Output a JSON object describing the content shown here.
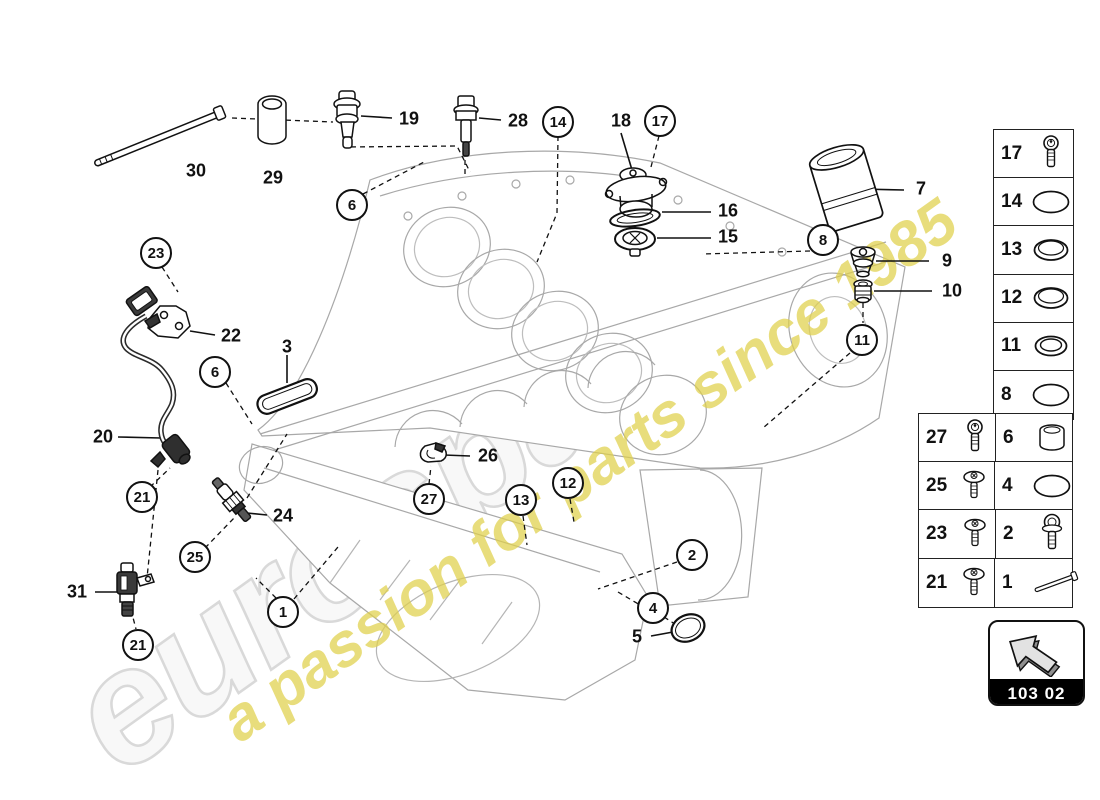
{
  "watermark": {
    "brand": "eurospares",
    "tagline": "a passion for parts since 1985",
    "brand_color": "#f8f8f8",
    "brand_outline": "#d9d9d9",
    "tagline_color": "#e0d04a"
  },
  "nav_box": {
    "code": "103 02"
  },
  "callouts": [
    {
      "n": "14",
      "x": 558,
      "y": 122
    },
    {
      "n": "17",
      "x": 660,
      "y": 121
    },
    {
      "n": "6",
      "x": 352,
      "y": 205
    },
    {
      "n": "8",
      "x": 823,
      "y": 240
    },
    {
      "n": "23",
      "x": 156,
      "y": 253
    },
    {
      "n": "11",
      "x": 862,
      "y": 340
    },
    {
      "n": "6",
      "x": 215,
      "y": 372
    },
    {
      "n": "12",
      "x": 568,
      "y": 483
    },
    {
      "n": "21",
      "x": 142,
      "y": 497
    },
    {
      "n": "27",
      "x": 429,
      "y": 499
    },
    {
      "n": "13",
      "x": 521,
      "y": 500
    },
    {
      "n": "2",
      "x": 692,
      "y": 555
    },
    {
      "n": "25",
      "x": 195,
      "y": 557
    },
    {
      "n": "4",
      "x": 653,
      "y": 608
    },
    {
      "n": "1",
      "x": 283,
      "y": 612
    },
    {
      "n": "21",
      "x": 138,
      "y": 645
    }
  ],
  "part_labels": [
    {
      "n": "30",
      "x": 196,
      "y": 171
    },
    {
      "n": "29",
      "x": 273,
      "y": 178
    },
    {
      "n": "19",
      "x": 409,
      "y": 119
    },
    {
      "n": "28",
      "x": 518,
      "y": 121
    },
    {
      "n": "18",
      "x": 621,
      "y": 121
    },
    {
      "n": "16",
      "x": 728,
      "y": 211
    },
    {
      "n": "15",
      "x": 728,
      "y": 237
    },
    {
      "n": "7",
      "x": 921,
      "y": 189
    },
    {
      "n": "9",
      "x": 947,
      "y": 261
    },
    {
      "n": "10",
      "x": 952,
      "y": 291
    },
    {
      "n": "22",
      "x": 231,
      "y": 336
    },
    {
      "n": "3",
      "x": 287,
      "y": 347
    },
    {
      "n": "20",
      "x": 103,
      "y": 437
    },
    {
      "n": "24",
      "x": 283,
      "y": 516
    },
    {
      "n": "31",
      "x": 77,
      "y": 592
    },
    {
      "n": "26",
      "x": 488,
      "y": 456
    },
    {
      "n": "5",
      "x": 637,
      "y": 637
    }
  ],
  "legend_column": {
    "rows": [
      {
        "num": "17",
        "icon": "socket-bolt"
      },
      {
        "num": "14",
        "icon": "o-ring"
      },
      {
        "num": "13",
        "icon": "seal-ring"
      },
      {
        "num": "12",
        "icon": "seal-ring"
      },
      {
        "num": "11",
        "icon": "seal-ring-double"
      },
      {
        "num": "8",
        "icon": "o-ring"
      }
    ]
  },
  "legend_grid": {
    "rows": [
      [
        {
          "num": "27",
          "icon": "socket-bolt"
        },
        {
          "num": "6",
          "icon": "sleeve"
        }
      ],
      [
        {
          "num": "25",
          "icon": "pan-screw"
        },
        {
          "num": "4",
          "icon": "o-ring"
        }
      ],
      [
        {
          "num": "23",
          "icon": "pan-screw"
        },
        {
          "num": "2",
          "icon": "flange-bolt"
        }
      ],
      [
        {
          "num": "21",
          "icon": "pan-screw"
        },
        {
          "num": "1",
          "icon": "long-stud"
        }
      ]
    ]
  }
}
